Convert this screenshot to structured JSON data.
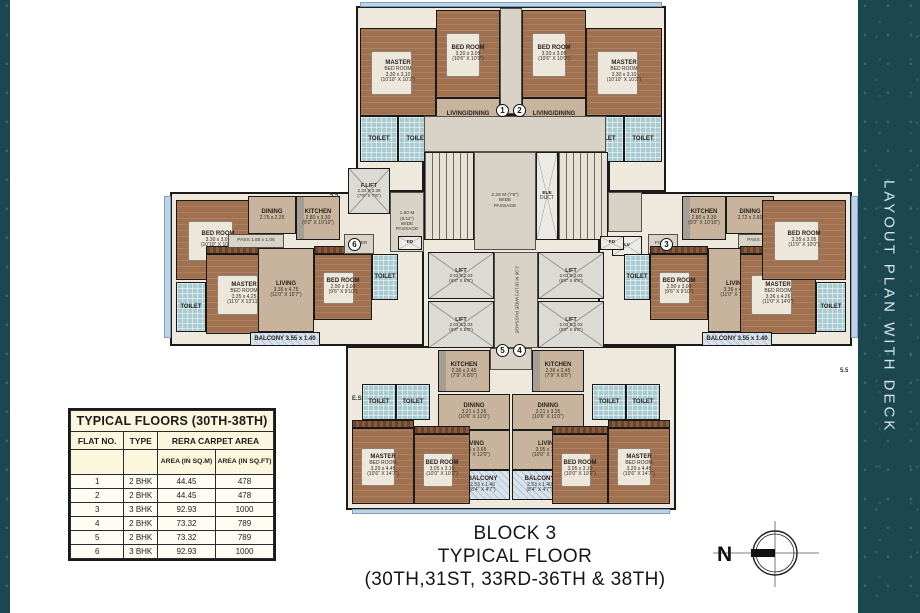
{
  "sidebar": {
    "label": "LAYOUT PLAN WITH DECK"
  },
  "block_title": {
    "line1": "BLOCK 3",
    "line2": "TYPICAL FLOOR",
    "line3": "(30TH,31ST, 33RD-36TH & 38TH)"
  },
  "compass": {
    "label": "N"
  },
  "colors": {
    "accent": "#1b4850",
    "bed": "#a1714f",
    "living": "#c8b49c",
    "toilet": "#a9cad0",
    "balcony": "#d7e2ea",
    "lift": "#dbdad4",
    "stair": "#e7e1d5",
    "hall": "#d9d3c7",
    "deck": "#bfd3e6",
    "tablebg": "#fbf6de"
  },
  "table": {
    "title": "TYPICAL FLOORS (30TH-38TH)",
    "col_headers": [
      "FLAT NO.",
      "TYPE",
      "RERA CARPET AREA"
    ],
    "sub_headers": [
      "AREA (IN SQ.M)",
      "AREA (IN SQ.FT)"
    ],
    "rows": [
      [
        "1",
        "2 BHK",
        "44.45",
        "478"
      ],
      [
        "2",
        "2 BHK",
        "44.45",
        "478"
      ],
      [
        "3",
        "3 BHK",
        "92.93",
        "1000"
      ],
      [
        "4",
        "2 BHK",
        "73.32",
        "789"
      ],
      [
        "5",
        "2 BHK",
        "73.32",
        "789"
      ],
      [
        "6",
        "3 BHK",
        "92.93",
        "1000"
      ]
    ]
  },
  "plan": {
    "outlines": [
      {
        "id": "top-wing",
        "x": 356,
        "y": 6,
        "w": 310,
        "h": 186
      },
      {
        "id": "core",
        "x": 422,
        "y": 114,
        "w": 188,
        "h": 236
      },
      {
        "id": "left-wing",
        "x": 170,
        "y": 192,
        "w": 254,
        "h": 154
      },
      {
        "id": "right-wing",
        "x": 598,
        "y": 192,
        "w": 254,
        "h": 154
      },
      {
        "id": "bottom-wing",
        "x": 346,
        "y": 346,
        "w": 330,
        "h": 164
      }
    ],
    "decks": [
      {
        "id": "deck-top",
        "x": 360,
        "y": 2,
        "w": 302,
        "h": 5
      },
      {
        "id": "deck-left",
        "x": 164,
        "y": 196,
        "w": 7,
        "h": 142
      },
      {
        "id": "deck-right",
        "x": 851,
        "y": 196,
        "w": 7,
        "h": 142
      },
      {
        "id": "deck-bottom",
        "x": 352,
        "y": 509,
        "w": 318,
        "h": 5
      }
    ],
    "rooms": [
      {
        "id": "f1-bedroom",
        "x": 436,
        "y": 10,
        "w": 64,
        "h": 88,
        "t": "bed",
        "label": [
          "BED ROOM",
          "3.20 x 3.05",
          "(10'6\" X 10'0\")"
        ]
      },
      {
        "id": "f1-master-bedroom",
        "x": 360,
        "y": 28,
        "w": 76,
        "h": 88,
        "t": "bed",
        "label": [
          "MASTER",
          "BED ROOM",
          "3.30 x 3.10",
          "(10'10\" X 10'2\")"
        ]
      },
      {
        "id": "f1-toilet-1",
        "x": 360,
        "y": 116,
        "w": 38,
        "h": 46,
        "t": "toilet",
        "label": [
          "TOILET"
        ]
      },
      {
        "id": "f1-toilet-2",
        "x": 398,
        "y": 116,
        "w": 38,
        "h": 46,
        "t": "toilet",
        "label": [
          "TOILET"
        ]
      },
      {
        "id": "f1-living-dining",
        "x": 436,
        "y": 98,
        "w": 64,
        "h": 44,
        "t": "living",
        "label": [
          "LIVING/DINING",
          "4.16 x 3.05",
          "(13'8\" X 10'0\")"
        ]
      },
      {
        "id": "f1-kitchen",
        "x": 436,
        "y": 142,
        "w": 46,
        "h": 46,
        "t": "kitchen",
        "label": [
          "KITCHEN",
          "2.13 x 2.12"
        ]
      },
      {
        "id": "f1-duct",
        "x": 482,
        "y": 142,
        "w": 18,
        "h": 46,
        "t": "duct",
        "label": []
      },
      {
        "id": "top-corridor",
        "x": 500,
        "y": 8,
        "w": 22,
        "h": 106,
        "t": "hall",
        "label": []
      },
      {
        "id": "f2-bedroom",
        "x": 522,
        "y": 10,
        "w": 64,
        "h": 88,
        "t": "bed",
        "label": [
          "BED ROOM",
          "3.20 x 3.05",
          "(10'6\" X 10'0\")"
        ]
      },
      {
        "id": "f2-master-bedroom",
        "x": 586,
        "y": 28,
        "w": 76,
        "h": 88,
        "t": "bed",
        "label": [
          "MASTER",
          "BED ROOM",
          "3.30 x 3.10",
          "(10'10\" X 10'2\")"
        ]
      },
      {
        "id": "f2-toilet-1",
        "x": 586,
        "y": 116,
        "w": 38,
        "h": 46,
        "t": "toilet",
        "label": [
          "TOILET"
        ]
      },
      {
        "id": "f2-toilet-2",
        "x": 624,
        "y": 116,
        "w": 38,
        "h": 46,
        "t": "toilet",
        "label": [
          "TOILET"
        ]
      },
      {
        "id": "f2-living-dining",
        "x": 522,
        "y": 98,
        "w": 64,
        "h": 44,
        "t": "living",
        "label": [
          "LIVING/DINING",
          "4.16 x 3.05",
          "(13'8\" X 10'0\")"
        ]
      },
      {
        "id": "f2-kitchen",
        "x": 540,
        "y": 142,
        "w": 46,
        "h": 46,
        "t": "kitchen",
        "label": [
          "KITCHEN",
          "2.13 x 2.12"
        ]
      },
      {
        "id": "f2-duct",
        "x": 522,
        "y": 142,
        "w": 18,
        "h": 46,
        "t": "duct",
        "label": []
      },
      {
        "id": "core-hall-top",
        "x": 424,
        "y": 116,
        "w": 182,
        "h": 36,
        "t": "hall",
        "label": []
      },
      {
        "id": "stair-left",
        "x": 424,
        "y": 152,
        "w": 50,
        "h": 88,
        "t": "stair",
        "label": []
      },
      {
        "id": "core-passage",
        "x": 474,
        "y": 152,
        "w": 62,
        "h": 98,
        "t": "hall",
        "label": [
          "2.28 M (7'6\")",
          "WIDE",
          "PASSAGE"
        ]
      },
      {
        "id": "ele-duct",
        "x": 536,
        "y": 152,
        "w": 22,
        "h": 88,
        "t": "duct",
        "label": [
          "ELE",
          "DUCT"
        ]
      },
      {
        "id": "stair-right",
        "x": 558,
        "y": 152,
        "w": 50,
        "h": 88,
        "t": "stair",
        "label": []
      },
      {
        "id": "fire-lift",
        "x": 348,
        "y": 168,
        "w": 42,
        "h": 46,
        "t": "lift",
        "label": [
          "F.LIFT",
          "2.34 X 2.39",
          "(7'8\" X 7'8\")"
        ]
      },
      {
        "id": "hall-left",
        "x": 390,
        "y": 192,
        "w": 34,
        "h": 60,
        "t": "hall",
        "label": [
          "1.80 M",
          "(5'11\")",
          "WIDE",
          "PASSAGE"
        ]
      },
      {
        "id": "hall-right",
        "x": 608,
        "y": 192,
        "w": 34,
        "h": 40,
        "t": "hall",
        "label": []
      },
      {
        "id": "lv-duct",
        "x": 612,
        "y": 236,
        "w": 30,
        "h": 20,
        "t": "duct",
        "label": [
          "LV"
        ]
      },
      {
        "id": "lift-1",
        "x": 428,
        "y": 252,
        "w": 66,
        "h": 47,
        "t": "lift",
        "label": [
          "LIFT",
          "2.03 X 2.03",
          "(6'8\" X 6'8\")"
        ]
      },
      {
        "id": "lift-2",
        "x": 428,
        "y": 301,
        "w": 66,
        "h": 47,
        "t": "lift",
        "label": [
          "LIFT",
          "2.03 X 2.03",
          "(6'8\" X 6'8\")"
        ]
      },
      {
        "id": "lift-lobby",
        "x": 494,
        "y": 252,
        "w": 44,
        "h": 96,
        "t": "hall",
        "vert": true,
        "label": [
          "2.08 M (6'10\") WIDE PASSAGE"
        ]
      },
      {
        "id": "lift-3",
        "x": 538,
        "y": 252,
        "w": 66,
        "h": 47,
        "t": "lift",
        "label": [
          "LIFT",
          "2.03 X 2.03",
          "(6'8\" X 6'8\")"
        ]
      },
      {
        "id": "lift-4",
        "x": 538,
        "y": 301,
        "w": 66,
        "h": 47,
        "t": "lift",
        "label": [
          "LIFT",
          "2.03 X 2.03",
          "(6'8\" X 6'8\")"
        ]
      },
      {
        "id": "bottom-corridor",
        "x": 490,
        "y": 348,
        "w": 42,
        "h": 22,
        "t": "hall",
        "label": []
      },
      {
        "id": "f6-bedroom-1",
        "x": 176,
        "y": 200,
        "w": 84,
        "h": 80,
        "t": "bed",
        "label": [
          "BED ROOM",
          "3.30 x 3.05",
          "(10'10\" X 10'0\")"
        ]
      },
      {
        "id": "f6-toilet-1",
        "x": 176,
        "y": 282,
        "w": 30,
        "h": 50,
        "t": "toilet",
        "label": [
          "TOILET"
        ]
      },
      {
        "id": "f6-wardrobe-1",
        "x": 206,
        "y": 246,
        "w": 76,
        "h": 8,
        "t": "ward",
        "label": []
      },
      {
        "id": "f6-master-bedroom",
        "x": 206,
        "y": 254,
        "w": 76,
        "h": 80,
        "t": "bed",
        "label": [
          "MASTER",
          "BED ROOM",
          "3.35 x 4.25",
          "(11'0\" X 13'11\")"
        ]
      },
      {
        "id": "f6-pass",
        "x": 228,
        "y": 234,
        "w": 56,
        "h": 14,
        "t": "hall",
        "label": [
          "PASS 1.65 x 1.05"
        ]
      },
      {
        "id": "f6-dining",
        "x": 248,
        "y": 196,
        "w": 48,
        "h": 38,
        "t": "living",
        "label": [
          "DINING",
          "2.75 x 2.25"
        ]
      },
      {
        "id": "f6-kitchen",
        "x": 296,
        "y": 196,
        "w": 44,
        "h": 44,
        "t": "kitchen",
        "label": [
          "KITCHEN",
          "2.80 x 3.30",
          "(9'2\" X 10'10\")"
        ]
      },
      {
        "id": "f6-living",
        "x": 258,
        "y": 248,
        "w": 56,
        "h": 84,
        "t": "living",
        "label": [
          "LIVING",
          "3.36 x 4.75",
          "(11'0\" X 15'7\")"
        ]
      },
      {
        "id": "f6-wardrobe-2",
        "x": 314,
        "y": 246,
        "w": 58,
        "h": 8,
        "t": "ward",
        "label": []
      },
      {
        "id": "f6-bedroom-2",
        "x": 314,
        "y": 254,
        "w": 58,
        "h": 66,
        "t": "bed",
        "label": [
          "BED ROOM",
          "2.90 x 3.00",
          "(9'6\" X 9'10\")"
        ]
      },
      {
        "id": "f6-toilet-2",
        "x": 372,
        "y": 254,
        "w": 26,
        "h": 46,
        "t": "toilet",
        "label": [
          "TOILET"
        ]
      },
      {
        "id": "f6-balcony",
        "x": 250,
        "y": 332,
        "w": 70,
        "h": 14,
        "t": "balcony",
        "label": [
          "BALCONY 3.55 x 1.40"
        ]
      },
      {
        "id": "f6-foyer",
        "x": 344,
        "y": 234,
        "w": 30,
        "h": 20,
        "t": "hall",
        "label": [
          "FOYER"
        ]
      },
      {
        "id": "f6-fd",
        "x": 398,
        "y": 236,
        "w": 24,
        "h": 14,
        "t": "duct",
        "label": [
          "FD"
        ]
      },
      {
        "id": "f3-fd",
        "x": 600,
        "y": 236,
        "w": 24,
        "h": 14,
        "t": "duct",
        "label": [
          "FD"
        ]
      },
      {
        "id": "f3-foyer",
        "x": 648,
        "y": 234,
        "w": 30,
        "h": 20,
        "t": "hall",
        "label": [
          "FOYER"
        ]
      },
      {
        "id": "f3-toilet-2",
        "x": 624,
        "y": 254,
        "w": 26,
        "h": 46,
        "t": "toilet",
        "label": [
          "TOILET"
        ]
      },
      {
        "id": "f3-bedroom-2",
        "x": 650,
        "y": 254,
        "w": 58,
        "h": 66,
        "t": "bed",
        "label": [
          "BED ROOM",
          "2.90 x 3.00",
          "(9'6\" X 9'10\")"
        ]
      },
      {
        "id": "f3-wardrobe-2",
        "x": 650,
        "y": 246,
        "w": 58,
        "h": 8,
        "t": "ward",
        "label": []
      },
      {
        "id": "f3-living",
        "x": 708,
        "y": 248,
        "w": 56,
        "h": 84,
        "t": "living",
        "label": [
          "LIVING",
          "3.36 x 4.75",
          "(11'0\" X 15'7\")"
        ]
      },
      {
        "id": "f3-kitchen",
        "x": 682,
        "y": 196,
        "w": 44,
        "h": 44,
        "t": "kitchen",
        "label": [
          "KITCHEN",
          "2.80 x 3.30",
          "(9'2\" X 10'10\")"
        ]
      },
      {
        "id": "f3-dining",
        "x": 726,
        "y": 196,
        "w": 48,
        "h": 38,
        "t": "living",
        "label": [
          "DINING",
          "2.72 x 2.60"
        ]
      },
      {
        "id": "f3-pass",
        "x": 738,
        "y": 234,
        "w": 56,
        "h": 14,
        "t": "hall",
        "label": [
          "PASS 1.80 x 1.05"
        ]
      },
      {
        "id": "f3-master-bedroom",
        "x": 740,
        "y": 254,
        "w": 76,
        "h": 80,
        "t": "bed",
        "label": [
          "MASTER",
          "BED ROOM",
          "3.36 x 4.26",
          "(11'0\" X 14'0\")"
        ]
      },
      {
        "id": "f3-wardrobe-1",
        "x": 740,
        "y": 246,
        "w": 76,
        "h": 8,
        "t": "ward",
        "label": []
      },
      {
        "id": "f3-bedroom-1",
        "x": 762,
        "y": 200,
        "w": 84,
        "h": 80,
        "t": "bed",
        "label": [
          "BED ROOM",
          "3.35 x 3.05",
          "(11'0\" X 10'0\")"
        ]
      },
      {
        "id": "f3-toilet-1",
        "x": 816,
        "y": 282,
        "w": 30,
        "h": 50,
        "t": "toilet",
        "label": [
          "TOILET"
        ]
      },
      {
        "id": "f3-balcony",
        "x": 702,
        "y": 332,
        "w": 70,
        "h": 14,
        "t": "balcony",
        "label": [
          "BALCONY 3.55 x 1.40"
        ]
      },
      {
        "id": "f5-kitchen",
        "x": 438,
        "y": 350,
        "w": 52,
        "h": 42,
        "t": "kitchen",
        "label": [
          "KITCHEN",
          "2.36 x 2.45",
          "(7'9\" X 8'0\")"
        ]
      },
      {
        "id": "f5-dining",
        "x": 438,
        "y": 394,
        "w": 72,
        "h": 36,
        "t": "living",
        "label": [
          "DINING",
          "3.21 x 3.35",
          "(10'6\" X 11'0\")"
        ]
      },
      {
        "id": "f5-living",
        "x": 438,
        "y": 430,
        "w": 72,
        "h": 40,
        "t": "living",
        "label": [
          "LIVING",
          "3.05 x 3.65",
          "(10'0\" X 12'0\")"
        ]
      },
      {
        "id": "f5-balcony",
        "x": 455,
        "y": 470,
        "w": 55,
        "h": 30,
        "t": "balcony",
        "label": [
          "BALCONY",
          "2.53 x 1.40",
          "(8'4\" X 4'7\")"
        ]
      },
      {
        "id": "f5-toilet-1",
        "x": 362,
        "y": 384,
        "w": 34,
        "h": 36,
        "t": "toilet",
        "label": [
          "TOILET"
        ]
      },
      {
        "id": "f5-toilet-2",
        "x": 396,
        "y": 384,
        "w": 34,
        "h": 36,
        "t": "toilet",
        "label": [
          "TOILET"
        ]
      },
      {
        "id": "f5-wardrobe-1",
        "x": 352,
        "y": 420,
        "w": 62,
        "h": 8,
        "t": "ward",
        "label": []
      },
      {
        "id": "f5-master-bedroom",
        "x": 352,
        "y": 428,
        "w": 62,
        "h": 76,
        "t": "bed",
        "label": [
          "MASTER",
          "BED ROOM",
          "3.20 x 4.45",
          "(10'6\" X 14'7\")"
        ]
      },
      {
        "id": "f5-wardrobe-2",
        "x": 414,
        "y": 426,
        "w": 56,
        "h": 8,
        "t": "ward",
        "label": []
      },
      {
        "id": "f5-bedroom",
        "x": 414,
        "y": 434,
        "w": 56,
        "h": 70,
        "t": "bed",
        "label": [
          "BED ROOM",
          "3.05 x 3.10",
          "(10'0\" X 10'2\")"
        ]
      },
      {
        "id": "f4-kitchen",
        "x": 532,
        "y": 350,
        "w": 52,
        "h": 42,
        "t": "kitchen",
        "label": [
          "KITCHEN",
          "2.36 x 2.45",
          "(7'9\" X 8'0\")"
        ]
      },
      {
        "id": "f4-dining",
        "x": 512,
        "y": 394,
        "w": 72,
        "h": 36,
        "t": "living",
        "label": [
          "DINING",
          "3.21 x 3.35",
          "(10'6\" X 11'0\")"
        ]
      },
      {
        "id": "f4-living",
        "x": 512,
        "y": 430,
        "w": 72,
        "h": 40,
        "t": "living",
        "label": [
          "LIVING",
          "3.05 x 3.65",
          "(10'0\" X 12'0\")"
        ]
      },
      {
        "id": "f4-balcony",
        "x": 512,
        "y": 470,
        "w": 55,
        "h": 30,
        "t": "balcony",
        "label": [
          "BALCONY",
          "2.53 x 1.40",
          "(8'4\" X 4'7\")"
        ]
      },
      {
        "id": "f4-toilet-1",
        "x": 626,
        "y": 384,
        "w": 34,
        "h": 36,
        "t": "toilet",
        "label": [
          "TOILET"
        ]
      },
      {
        "id": "f4-toilet-2",
        "x": 592,
        "y": 384,
        "w": 34,
        "h": 36,
        "t": "toilet",
        "label": [
          "TOILET"
        ]
      },
      {
        "id": "f4-wardrobe-1",
        "x": 608,
        "y": 420,
        "w": 62,
        "h": 8,
        "t": "ward",
        "label": []
      },
      {
        "id": "f4-master-bedroom",
        "x": 608,
        "y": 428,
        "w": 62,
        "h": 76,
        "t": "bed",
        "label": [
          "MASTER",
          "BED ROOM",
          "3.20 x 4.45",
          "(10'6\" X 14'7\")"
        ]
      },
      {
        "id": "f4-wardrobe-2",
        "x": 552,
        "y": 426,
        "w": 56,
        "h": 8,
        "t": "ward",
        "label": []
      },
      {
        "id": "f4-bedroom",
        "x": 552,
        "y": 434,
        "w": 56,
        "h": 70,
        "t": "bed",
        "label": [
          "BED ROOM",
          "3.05 x 3.10",
          "(10'0\" X 10'2\")"
        ]
      }
    ],
    "unit_markers": [
      {
        "n": "1",
        "x": 496,
        "y": 104
      },
      {
        "n": "2",
        "x": 513,
        "y": 104
      },
      {
        "n": "3",
        "x": 660,
        "y": 238
      },
      {
        "n": "4",
        "x": 513,
        "y": 344
      },
      {
        "n": "5",
        "x": 496,
        "y": 344
      },
      {
        "n": "6",
        "x": 348,
        "y": 238
      }
    ],
    "notes": [
      {
        "x": 330,
        "y": 193,
        "text": "5.5"
      },
      {
        "x": 840,
        "y": 368,
        "text": "5.5"
      },
      {
        "x": 352,
        "y": 396,
        "text": "E.S"
      }
    ]
  }
}
